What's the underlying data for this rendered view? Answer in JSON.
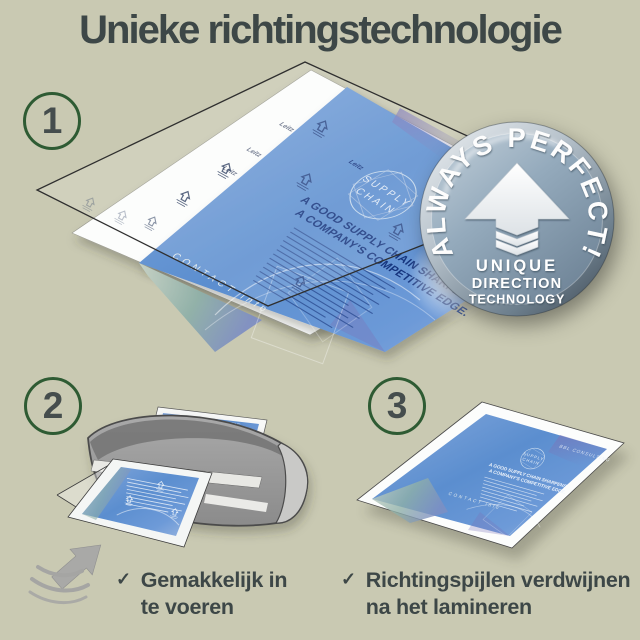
{
  "title": "Unieke richtingstechnologie",
  "steps": [
    {
      "number": "1"
    },
    {
      "number": "2",
      "caption": [
        "Gemakkelijk in",
        "te voeren"
      ]
    },
    {
      "number": "3",
      "caption": [
        "Richtingspijlen verdwijnen",
        "na het lamineren"
      ]
    }
  ],
  "badge": {
    "arc_text": "ALWAYS PERFECT!",
    "line1": "UNIQUE",
    "line2": "DIRECTION",
    "line3": "TECHNOLOGY"
  },
  "illustrations": {
    "leitz_logo": "Leitz",
    "document": {
      "brand": "BBL CONSULTING",
      "logo_line1": "SUPPLY",
      "logo_line2": "CHAIN",
      "headline_line1": "A GOOD SUPPLY CHAIN SHARPENS",
      "headline_line2": "A COMPANY'S COMPETITIVE EDGE.",
      "footer": "CONTACT info"
    }
  },
  "icons": {
    "checkmark": "✓"
  },
  "colors": {
    "background": "#c9c9b2",
    "text_dark": "#3d4747",
    "step_circle_green": "#2e5b33",
    "document_blue": "#5b8ecf",
    "badge_metal": "#8fa5b6",
    "machine_gray": "#9a9a9a"
  }
}
